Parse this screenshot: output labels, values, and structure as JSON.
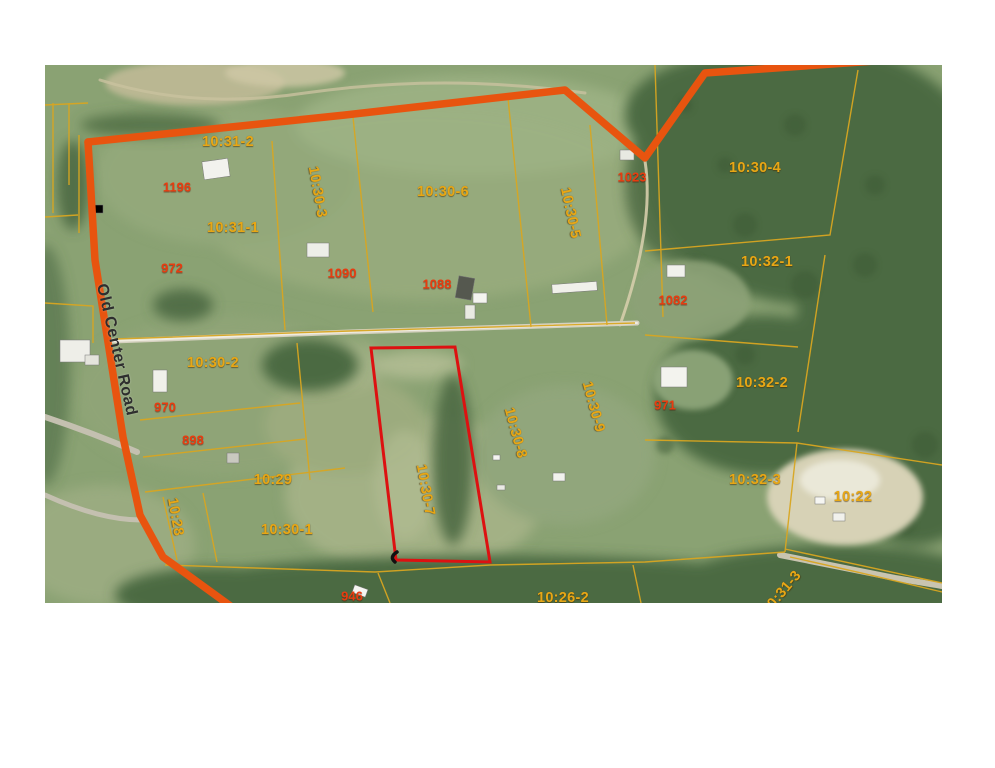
{
  "map": {
    "description": "Aerial parcel map with lot boundaries and highlighted lot",
    "road_name": "Old Center Road",
    "highlighted_parcel_id": "10:30-7"
  },
  "colors": {
    "road_orange": "#e8540f",
    "parcel_line": "#d8a621",
    "parcel_label": "#e8a715",
    "owner_label": "#e83c0f",
    "highlight_red": "#dd1111",
    "road_text": "#2e2e2e"
  },
  "labels": [
    {
      "text": "10:31-2",
      "type": "parcel",
      "x": 183,
      "y": 77,
      "rot": 0
    },
    {
      "text": "10:30-3",
      "type": "parcel",
      "x": 272,
      "y": 127,
      "rot": 80
    },
    {
      "text": "10:31-1",
      "type": "parcel",
      "x": 188,
      "y": 163,
      "rot": 0
    },
    {
      "text": "10:30-6",
      "type": "parcel",
      "x": 398,
      "y": 127,
      "rot": 0
    },
    {
      "text": "10:30-5",
      "type": "parcel",
      "x": 525,
      "y": 148,
      "rot": 78
    },
    {
      "text": "10:30-4",
      "type": "parcel",
      "x": 710,
      "y": 103,
      "rot": 0
    },
    {
      "text": "10:32-1",
      "type": "parcel",
      "x": 722,
      "y": 197,
      "rot": 0
    },
    {
      "text": "10:30-2",
      "type": "parcel",
      "x": 168,
      "y": 298,
      "rot": 0
    },
    {
      "text": "10:29",
      "type": "parcel",
      "x": 228,
      "y": 415,
      "rot": 0
    },
    {
      "text": "10:28",
      "type": "parcel",
      "x": 130,
      "y": 452,
      "rot": 80
    },
    {
      "text": "10:30-1",
      "type": "parcel",
      "x": 242,
      "y": 465,
      "rot": 0
    },
    {
      "text": "10:30-7",
      "type": "parcel",
      "x": 380,
      "y": 425,
      "rot": 80
    },
    {
      "text": "10:30-8",
      "type": "parcel",
      "x": 470,
      "y": 368,
      "rot": 75
    },
    {
      "text": "10:30-9",
      "type": "parcel",
      "x": 548,
      "y": 342,
      "rot": 75
    },
    {
      "text": "10:32-2",
      "type": "parcel",
      "x": 717,
      "y": 318,
      "rot": 0
    },
    {
      "text": "10:32-3",
      "type": "parcel",
      "x": 710,
      "y": 415,
      "rot": 0
    },
    {
      "text": "10:22",
      "type": "parcel",
      "x": 808,
      "y": 432,
      "rot": 0
    },
    {
      "text": "10:26-2",
      "type": "parcel",
      "x": 518,
      "y": 533,
      "rot": 0
    },
    {
      "text": "10:31-3",
      "type": "parcel",
      "x": 737,
      "y": 528,
      "rot": -50
    },
    {
      "text": "1196",
      "type": "owner",
      "x": 132,
      "y": 122,
      "rot": 0
    },
    {
      "text": "972",
      "type": "owner",
      "x": 127,
      "y": 203,
      "rot": 0
    },
    {
      "text": "1090",
      "type": "owner",
      "x": 297,
      "y": 208,
      "rot": 0
    },
    {
      "text": "1088",
      "type": "owner",
      "x": 392,
      "y": 219,
      "rot": 0
    },
    {
      "text": "1023",
      "type": "owner",
      "x": 587,
      "y": 112,
      "rot": 0
    },
    {
      "text": "1082",
      "type": "owner",
      "x": 628,
      "y": 235,
      "rot": 0
    },
    {
      "text": "971",
      "type": "owner",
      "x": 620,
      "y": 340,
      "rot": 0
    },
    {
      "text": "970",
      "type": "owner",
      "x": 120,
      "y": 342,
      "rot": 0
    },
    {
      "text": "898",
      "type": "owner",
      "x": 148,
      "y": 375,
      "rot": 0
    },
    {
      "text": "946",
      "type": "owner",
      "x": 307,
      "y": 531,
      "rot": 0
    },
    {
      "text": "Old Center Road",
      "type": "road",
      "x": 71,
      "y": 285,
      "rot": 77
    }
  ]
}
